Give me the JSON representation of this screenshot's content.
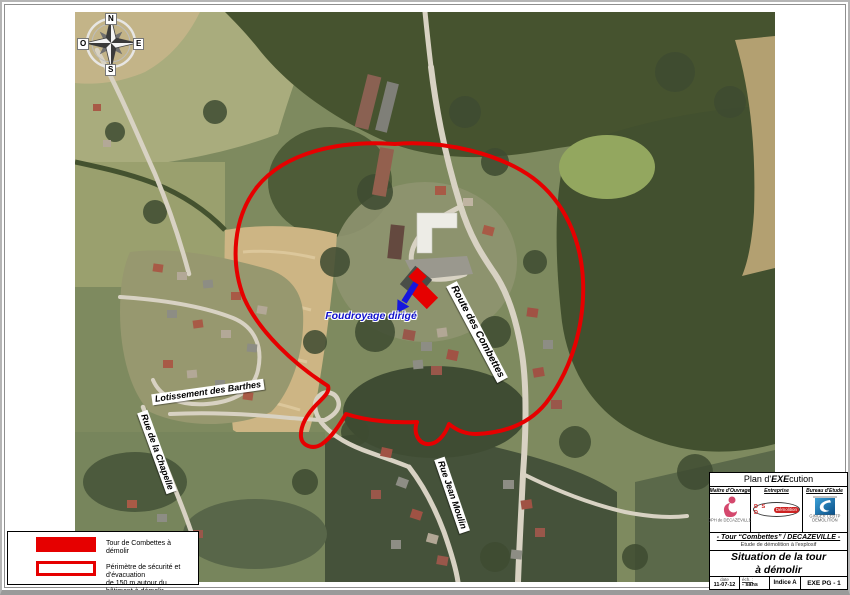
{
  "compass": {
    "n": "N",
    "e": "E",
    "s": "S",
    "o": "O"
  },
  "map_labels": {
    "foudroyage": "Foudroyage dirigé",
    "route_combettes": "Route des Combettes",
    "lotissement_barthes": "Lotissement des Barthes",
    "rue_chapelle": "Rue de la Chapelle",
    "rue_jean_moulin": "Rue Jean Moulin"
  },
  "legend": {
    "item1_label": "Tour de Combettes à démolir",
    "item2_line1": "Périmètre de sécurité et d'évacuation",
    "item2_line2": "de 150 m autour du bâtiment à démolir"
  },
  "title_block": {
    "header_prefix": "Plan d'",
    "header_em": "EXE",
    "header_suffix": "cution",
    "col1_header": "Maître d'Ouvrage",
    "col1_caption": "OPH de DECAZEVILLE",
    "col2_header": "Entreprise",
    "col2_logo_main": "D S D",
    "col2_logo_sub": "Démolition",
    "col3_header": "Bureau d'Etude",
    "col3_caption1": "GINGER CEBTP",
    "col3_caption2": "DEMOLITION",
    "project_line": "- Tour “Combettes” / DECAZEVILLE -",
    "project_subtitle": "Etude de démolition à l'explosif",
    "title_line1": "Situation de la tour",
    "title_line2": "à démolir",
    "date_label": "date",
    "date_value": "11-07-12",
    "scale_label": "éch. :",
    "scale_value": "- sans",
    "indice": "Indice A",
    "ref": "EXE PG - 1"
  },
  "colors": {
    "perimeter_red": "#e60000",
    "tower_red": "#e60000",
    "arrow_blue": "#1616dd",
    "foudroyage_blue": "#1111cc"
  }
}
